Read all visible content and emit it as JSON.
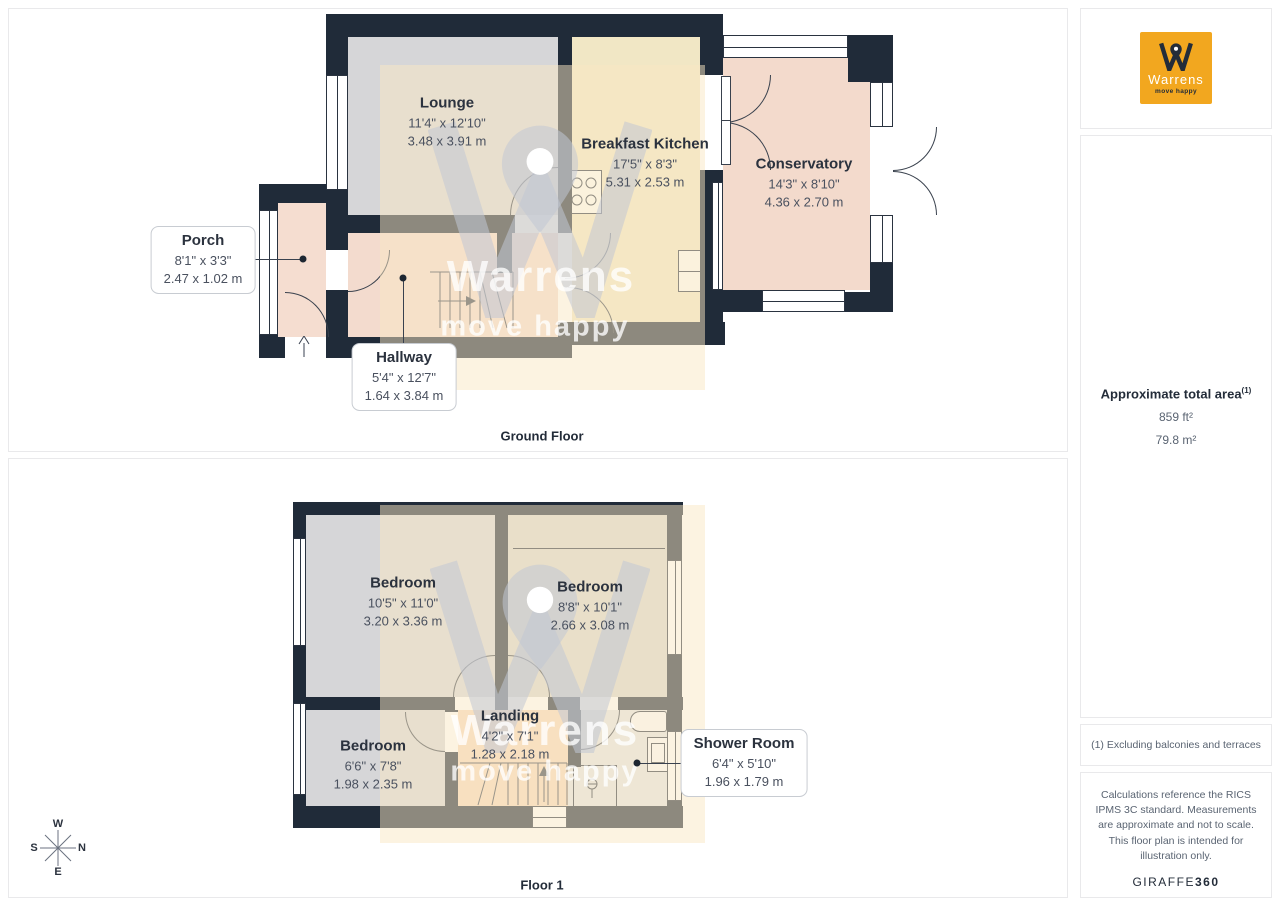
{
  "brand": {
    "name": "Warrens",
    "tagline": "move happy"
  },
  "floors": [
    {
      "name": "Ground Floor",
      "rooms": [
        {
          "name": "Lounge",
          "imperial": "11'4\" x 12'10\"",
          "metric": "3.48 x 3.91 m"
        },
        {
          "name": "Breakfast Kitchen",
          "imperial": "17'5\" x 8'3\"",
          "metric": "5.31 x 2.53 m"
        },
        {
          "name": "Conservatory",
          "imperial": "14'3\" x 8'10\"",
          "metric": "4.36 x 2.70 m"
        },
        {
          "name": "Porch",
          "imperial": "8'1\" x 3'3\"",
          "metric": "2.47 x 1.02 m"
        },
        {
          "name": "Hallway",
          "imperial": "5'4\" x 12'7\"",
          "metric": "1.64 x 3.84 m"
        }
      ]
    },
    {
      "name": "Floor 1",
      "rooms": [
        {
          "name": "Bedroom",
          "imperial": "10'5\" x 11'0\"",
          "metric": "3.20 x 3.36 m"
        },
        {
          "name": "Bedroom",
          "imperial": "8'8\" x 10'1\"",
          "metric": "2.66 x 3.08 m"
        },
        {
          "name": "Bedroom",
          "imperial": "6'6\" x 7'8\"",
          "metric": "1.98 x 2.35 m"
        },
        {
          "name": "Landing",
          "imperial": "4'2\" x 7'1\"",
          "metric": "1.28 x 2.18 m"
        },
        {
          "name": "Shower Room",
          "imperial": "6'4\" x 5'10\"",
          "metric": "1.96 x 1.79 m"
        }
      ]
    }
  ],
  "sidebar": {
    "area_title": "Approximate total area",
    "area_superscript": "(1)",
    "area_imperial": "859 ft²",
    "area_metric": "79.8 m²",
    "footnote": "(1) Excluding balconies and terraces",
    "disclaimer": "Calculations reference the RICS IPMS 3C standard. Measurements are approximate and not to scale. This floor plan is intended for illustration only.",
    "credit_name": "GIRAFFE",
    "credit_suffix": "360"
  },
  "compass": {
    "n": "N",
    "e": "E",
    "s": "S",
    "w": "W"
  },
  "colors": {
    "wall": "#202b39",
    "logo_orange": "#f2a71f",
    "floor_gray": "#d6d6d8",
    "floor_cream": "#f1e7c5",
    "floor_pink": "#f3dacc",
    "floor_landing": "#f6d9bd",
    "floor_bath": "#e3e4e7"
  }
}
